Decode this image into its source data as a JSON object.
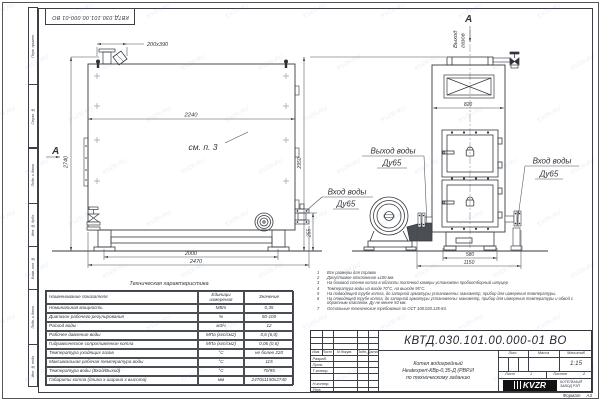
{
  "watermark": "KVZR.RU",
  "frame": {
    "doc_number_top": "КВТД.030.101.00.000-01 ВО",
    "margin_labels": [
      "Перв. примен.",
      "Справ. №",
      "Подп. и дата",
      "Инв. № дубл.",
      "Взам. инв. №",
      "Подп. и дата",
      "Инв. № подл."
    ],
    "format_label": "Формат",
    "format_value": "А3"
  },
  "front_view": {
    "view_arrow": "А",
    "dim_port": "200х390",
    "dim_width": "2240",
    "dim_height": "2740",
    "dim_base": "2000",
    "dim_overall": "2470",
    "dim_inlet_height": "255",
    "see_note": "см. п. 3",
    "inlet_line1": "Вход воды",
    "inlet_line2": "Ду65"
  },
  "side_view": {
    "view_arrow": "А",
    "gas_out_line1": "Выход",
    "gas_out_line2": "газов",
    "dim_top_width": "820",
    "dim_height": "2950",
    "dim_base": "580",
    "dim_overall": "1150",
    "outlet_line1": "Выход воды",
    "outlet_line2": "Ду65",
    "inlet_line1": "Вход воды",
    "inlet_line2": "Ду65"
  },
  "tech_table": {
    "title": "Техническая характеристика",
    "headers": [
      "Наименование показателя",
      "Единицы измерения",
      "Значение"
    ],
    "rows": [
      [
        "Номинальная мощность",
        "МВт",
        "0,35"
      ],
      [
        "Диапазон рабочего регулирования",
        "%",
        "50-100"
      ],
      [
        "Расход воды",
        "м3/ч",
        "12"
      ],
      [
        "Рабочее давление воды",
        "МПа (кгс/см2)",
        "0,6 (6,0)"
      ],
      [
        "Гидравлическое сопротивление котла",
        "МПа (кгс/см2)",
        "0,06 (0,6)"
      ],
      [
        "Температура уходящих газов",
        "°С",
        "не более 220"
      ],
      [
        "Максимальная рабочая температура воды",
        "°С",
        "115"
      ],
      [
        "Температура воды (Вход/Выход)",
        "°С",
        "70/95"
      ],
      [
        "Габариты котла (длина х ширина х высота)",
        "мм",
        "2470х1150х2740"
      ]
    ]
  },
  "notes": [
    {
      "n": "1",
      "text": "Все размеры для справок"
    },
    {
      "n": "2",
      "text": "Допустимое отклонение ±100 мм."
    },
    {
      "n": "3",
      "text": "На боковой стенке котла в области топочной камеры установлен пробоотборный штуцер"
    },
    {
      "n": "4",
      "text": "Температура воды на входе 70°С, на выходе 95°С."
    },
    {
      "n": "5",
      "text": "На подводящей трубе котла, до запорной арматуры установлены: манометр, прибор для измерения температуры."
    },
    {
      "n": "6",
      "text": "На отводящей трубе котла, до запорной арматуры установлены: манометр, прибор для измерения температуры и обвод с обратным клапаном. Ду не менее 50 мм."
    },
    {
      "n": "7",
      "text": "Остальные технические требования по ОСТ 108.030.135-84."
    }
  ],
  "title_block": {
    "doc_number": "КВТД.030.101.00.000-01 ВО",
    "name_lines": [
      "Котел водогрейный",
      "Heatexpert-КВр-0,35-Д (РВР.И",
      "по техническому заданию"
    ],
    "col_headers": [
      "Изм.",
      "Лист",
      "N докум.",
      "Подп.",
      "Дата"
    ],
    "row_labels": [
      "Разраб.",
      "Пров.",
      "Т.контр.",
      "Н.контр.",
      "Утв."
    ],
    "lit_label": "Лит.",
    "mass_label": "Масса",
    "scale_label": "Масштаб",
    "scale_value": "1:15",
    "sheet_label": "Лист",
    "sheet_value": "1",
    "sheets_label": "Листов",
    "sheets_value": "2",
    "logo_text": "KVZR",
    "company_line1": "КОТЕЛЬНЫЙ",
    "company_line2": "ЗАВОД РЭП"
  }
}
